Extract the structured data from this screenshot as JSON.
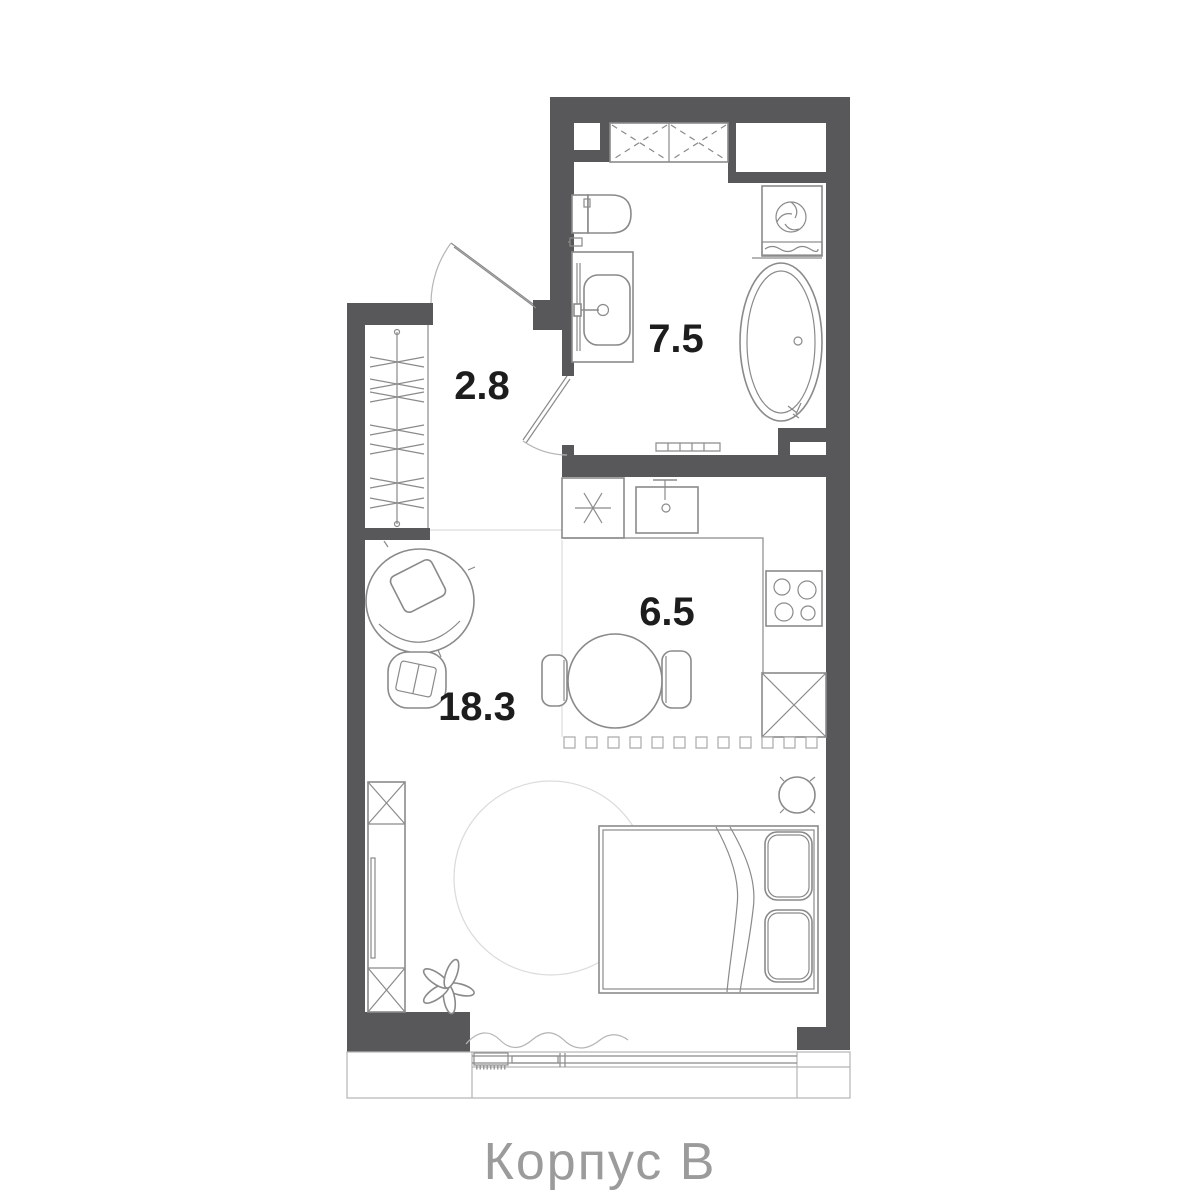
{
  "floor_plan": {
    "caption": "Корпус В",
    "rooms": [
      {
        "id": "hallway",
        "area": "2.8"
      },
      {
        "id": "bathroom",
        "area": "7.5"
      },
      {
        "id": "kitchen",
        "area": "6.5"
      },
      {
        "id": "living_room",
        "area": "18.3"
      }
    ],
    "fixtures": {
      "bathroom": [
        "overhead-cabinets",
        "shaft-niche",
        "washing-machine",
        "toilet",
        "paper-holder",
        "sink-vanity",
        "bathtub",
        "towel-rail",
        "bathroom-door"
      ],
      "hallway": [
        "entrance-door",
        "wardrobe-rail-with-hangers"
      ],
      "kitchen": [
        "fridge",
        "kitchen-sink",
        "counter",
        "hob",
        "base-cabinet",
        "dining-table",
        "chairs",
        "sliding-partition-track"
      ],
      "living_room": [
        "armchair",
        "pouf",
        "tall-cabinet",
        "plant",
        "round-rug",
        "double-bed",
        "pillows",
        "blanket",
        "nightstand",
        "window",
        "curtain",
        "radiator"
      ]
    },
    "colors": {
      "background": "#ffffff",
      "wall": "#58585a",
      "line": "#8a8a8a",
      "light_line": "#b5b5b5",
      "zone_line": "#e2e2e2",
      "label": "#1d1d1d",
      "caption": "#9b9b9b"
    }
  }
}
